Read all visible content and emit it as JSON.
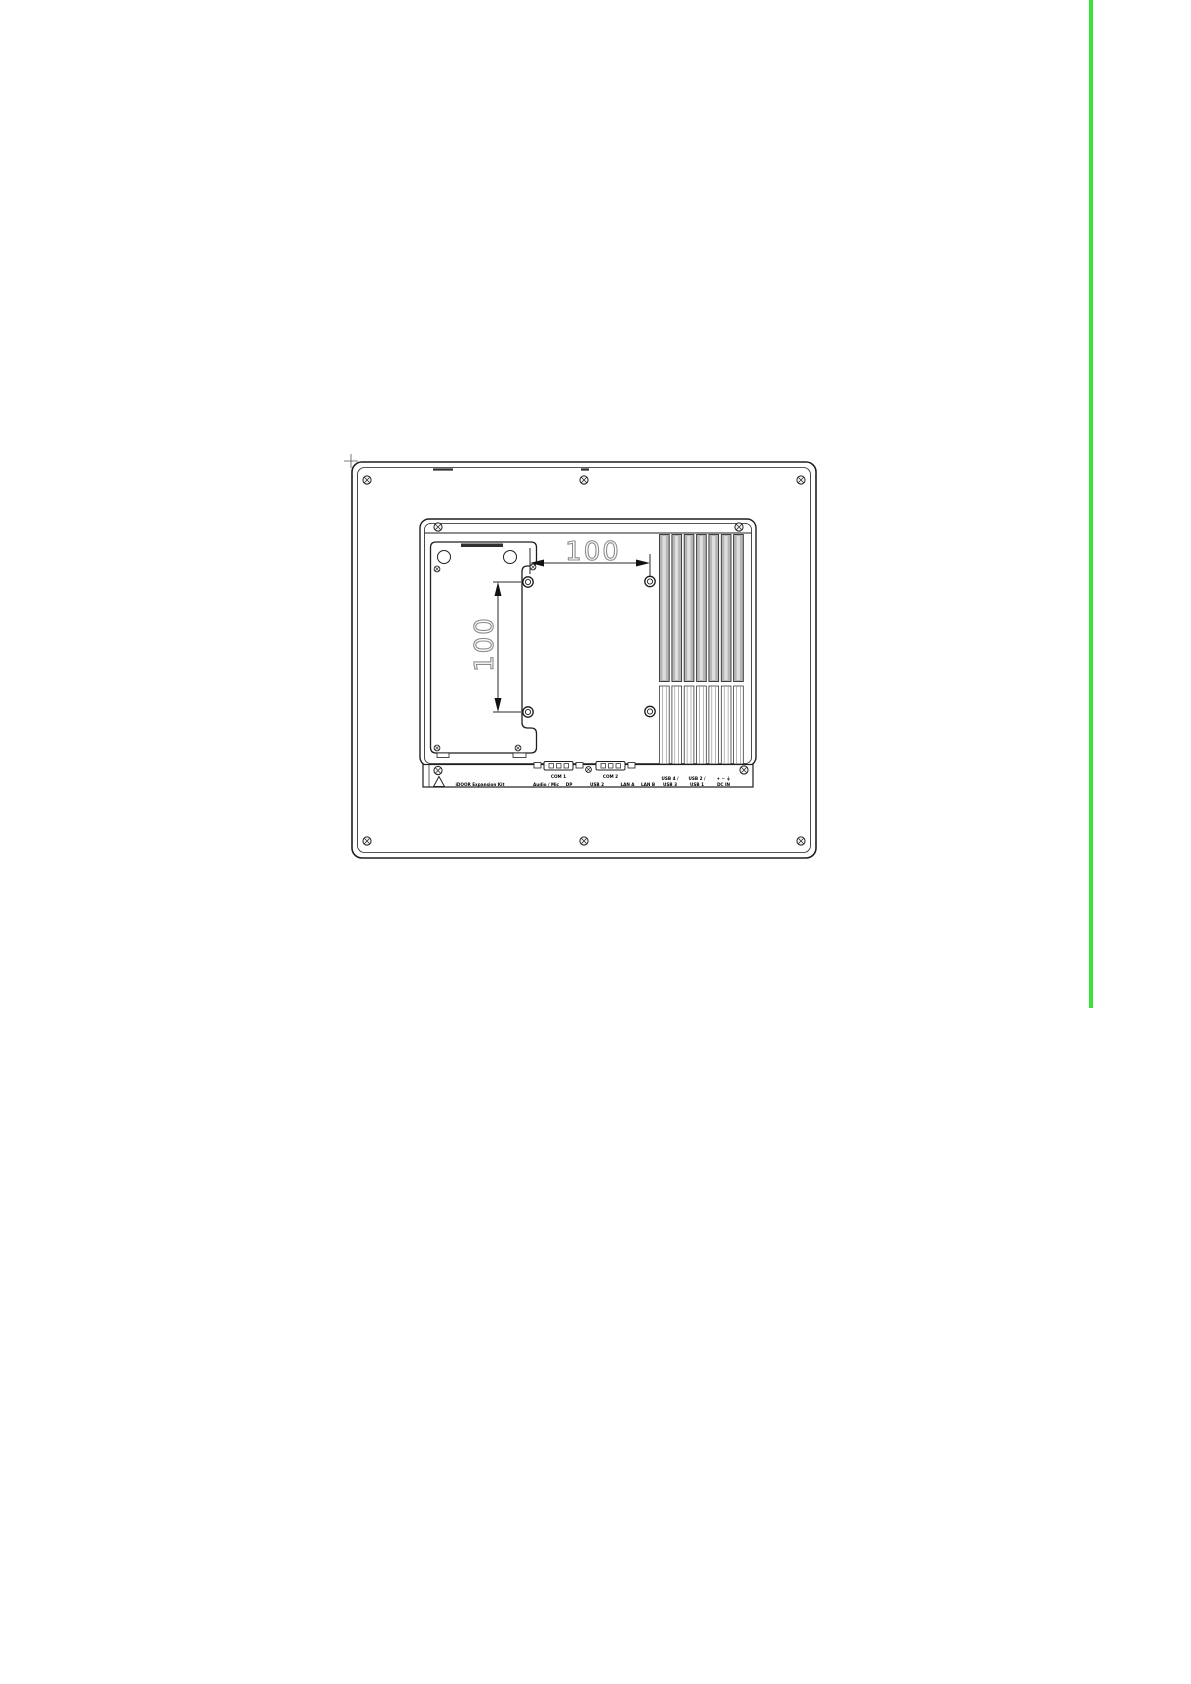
{
  "page": {
    "accent_bar_color": "#3ae23a",
    "background_color": "#ffffff",
    "line_color": "#1f1f1f"
  },
  "drawing": {
    "dim_horizontal": "100",
    "dim_vertical": "100",
    "io": {
      "com1": "COM 1",
      "com2": "COM 2",
      "expansion_kit": "iDOOR Expansion Kit",
      "audio": "Audio / Mic",
      "dp": "DP",
      "usb2": "USB 2",
      "lan_a": "LAN A",
      "lan_b": "LAN B",
      "usb43_top": "USB 4 /",
      "usb43_bottom": "USB 3",
      "usb21_top": "USB 2 /",
      "usb21_bottom": "USB 1",
      "dc_symbols": "+ − ⏚",
      "dc_in": "DC IN"
    }
  }
}
